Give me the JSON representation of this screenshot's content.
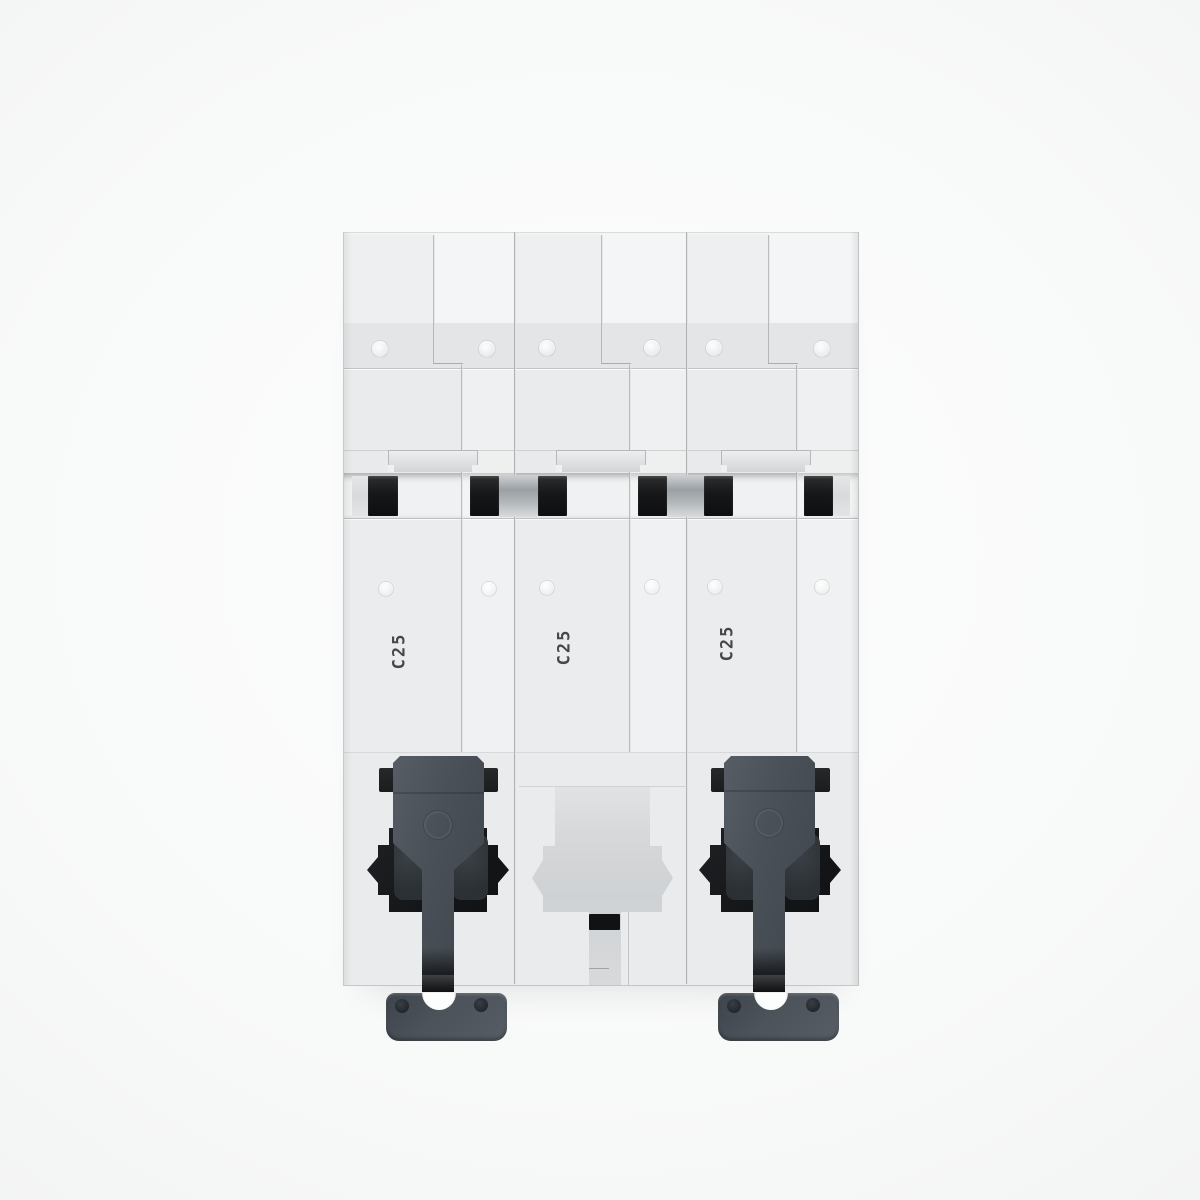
{
  "image": {
    "title": "3-pole miniature circuit breaker, rear view (DIN-rail mounting side)"
  },
  "device": {
    "module_count": 3,
    "modules": [
      {
        "marking": "C25"
      },
      {
        "marking": "C25"
      },
      {
        "marking": "C25"
      }
    ],
    "components": {
      "din_clip_left": "din-rail-clip",
      "din_clip_right": "din-rail-clip",
      "middle_recess": "empty-clip-recess",
      "rail_slots": 6
    }
  },
  "colors": {
    "background": "#f8f9f9",
    "housing": "#eaecee",
    "clip_gray": "#4a5158",
    "cavity_black": "#141618",
    "silver_contact": "#9aa0a4"
  }
}
